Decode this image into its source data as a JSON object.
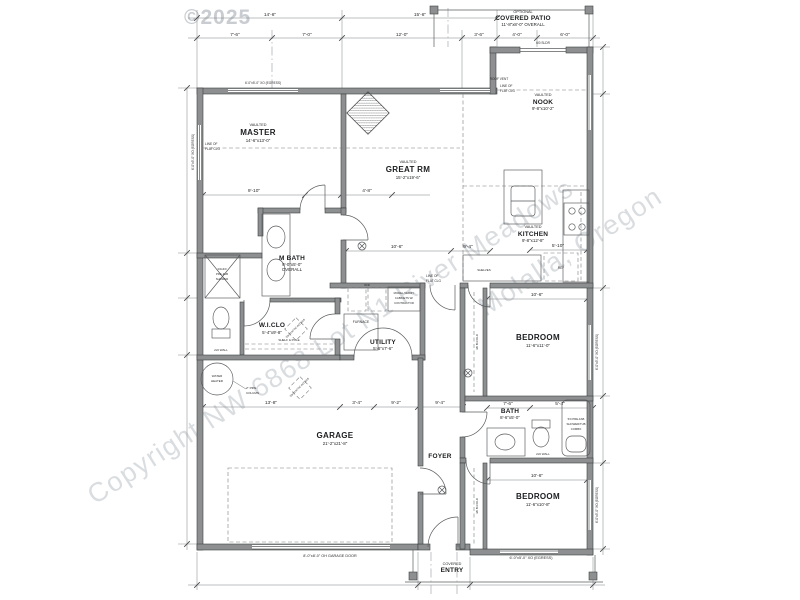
{
  "watermark": {
    "year": "©2025",
    "line1": "Copyright NW 6868 Lot N1 River Meadows",
    "line2": "Molalla, Oregon"
  },
  "rooms": {
    "patio": {
      "tag": "OPTIONAL",
      "name": "COVERED PATIO",
      "dims": "11'-8\"x8'-0\" OVERALL"
    },
    "nook": {
      "tag": "VAULTED",
      "name": "NOOK",
      "dims": "9'-8\"x10'-2\""
    },
    "kitchen": {
      "tag": "VAULTED",
      "name": "KITCHEN",
      "dims": "9'-8\"x12'-8\""
    },
    "master": {
      "tag": "VAULTED",
      "name": "MASTER",
      "dims": "14'-6\"x13'-0\""
    },
    "great": {
      "tag": "VAULTED",
      "name": "GREAT RM",
      "dims": "15'-2\"x19'-6\""
    },
    "mbath": {
      "name": "M BATH",
      "dims": "9'-0\"x5'-0\"",
      "dims2": "OVERALL"
    },
    "wiclo": {
      "name": "W.I.CLO",
      "dims": "5'-4\"x9'-8\""
    },
    "utility": {
      "name": "UTILITY",
      "dims": "5'-6\"x7'-6\""
    },
    "bedroom1": {
      "name": "BEDROOM",
      "dims": "11'-6\"x11'-0\""
    },
    "bath": {
      "name": "BATH",
      "dims": "8'-6\"x5'-0\""
    },
    "bedroom2": {
      "name": "BEDROOM",
      "dims": "11'-6\"x10'-8\""
    },
    "garage": {
      "name": "GARAGE",
      "dims": "21'-2\"x21'-8\""
    },
    "foyer": {
      "name": "FOYER"
    },
    "entry": {
      "tag": "COVERED",
      "name": "ENTRY"
    }
  },
  "dims": {
    "t1a": "14'-6\"",
    "t1b": "15'-6\"",
    "t2a": "7'-6\"",
    "t2b": "7'-0\"",
    "t2c": "12'-0\"",
    "t2d": "3'-6\"",
    "t2e": "4'-0\"",
    "t2f": "6'-0\"",
    "m1": "9'-10\"",
    "m2": "4'-8\"",
    "g1": "10'-6\"",
    "g2": "9'-4\"",
    "k1": "5'-10\"",
    "b1": "10'-6\"",
    "b2": "10'-6\"",
    "ba1": "7'-6\"",
    "ba2": "5'-4\"",
    "ga1": "13'-8\"",
    "ga2": "3'-4\"",
    "ga3": "9'-2\"",
    "ga4": "9'-4\""
  },
  "notes": {
    "egress_top": "6'-0\"x5'-0\" XO (EGRESS)",
    "egress_left": "6'-0\"x5'-0\" XO (EGRESS)",
    "egress_r1": "6'-0\"x5'-0\" XO (EGRESS)",
    "egress_r2": "6'-0\"x5'-0\" XO (EGRESS)",
    "egress_bottom": "6'-0\"x5'-0\" XO (EGRESS)",
    "garage_door": "8'-0\"x8'-0\" OH GARAGE DOOR",
    "slider": "6/0 SLDR",
    "roof_vent": "ROOF VENT",
    "line_of": "LINE OF",
    "flat_clg": "FLAT CLG",
    "wall26": "2x6 WALL",
    "pipe1": "2\" PIPE",
    "pipe2": "COLUMN",
    "shelf_pole": "SHELF & POLE",
    "attic": "30x30 ATTIC ACCESS",
    "bifold": "4/0 BI-FOLD",
    "shower1": "3/0x4/0",
    "shower2": "PRE-FAB",
    "shower3": "SHOWER",
    "tub1": "5/0 PRE-FAB",
    "tub2": "SHOWER/TUB",
    "tub3": "COMBO",
    "cab1": "MODEL VERIFY",
    "cab2": "CABINETS W/",
    "cab3": "CONTRACTOR"
  },
  "fixtures": {
    "water1": "WATER",
    "water2": "HEATER",
    "furnace": "FURNACE",
    "shelves": "SHELVES",
    "wd": "W/D",
    "ref": "REF"
  }
}
